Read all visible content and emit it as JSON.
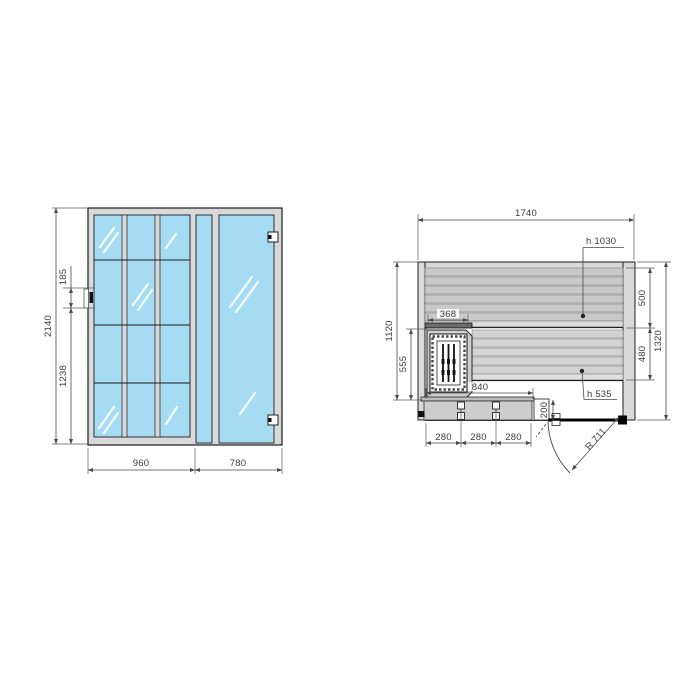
{
  "front": {
    "height": "2140",
    "offset_top": "185",
    "offset_bottom": "1238",
    "width_left": "960",
    "width_right": "780"
  },
  "plan": {
    "width": "1740",
    "depth": "1320",
    "inner_depth": "1120",
    "heater_zone_depth": "555",
    "heater_width": "368",
    "bench_upper_depth": "500",
    "bench_lower_depth": "480",
    "bench_upper_height": "h 1030",
    "bench_lower_height": "h 535",
    "front_bench_length": "840",
    "spacing": [
      "280",
      "280",
      "280"
    ],
    "step_depth": "200",
    "door_radius": "R 711"
  }
}
